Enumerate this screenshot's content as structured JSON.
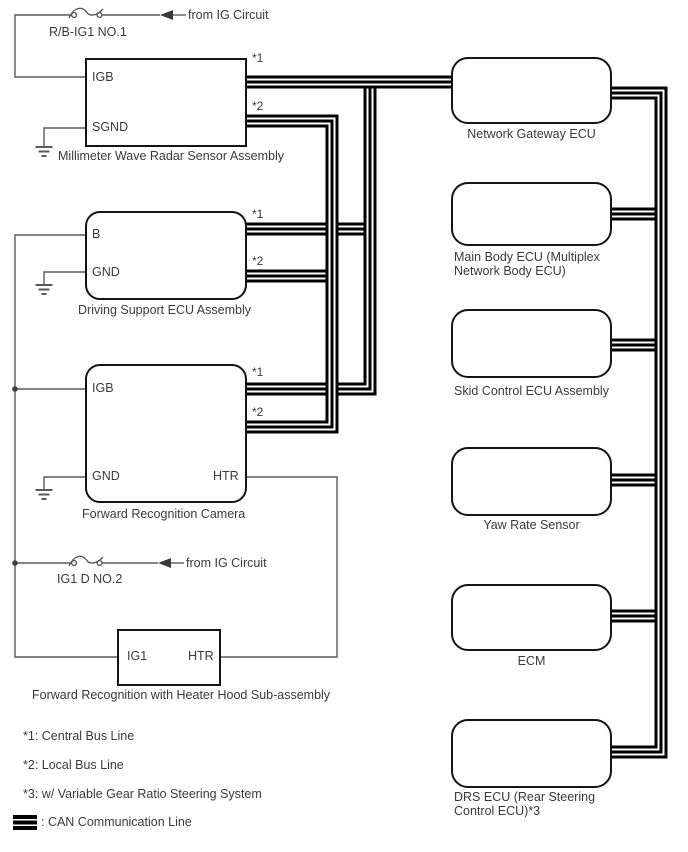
{
  "power": {
    "fuse1": {
      "label": "R/B-IG1 NO.1",
      "source": "from IG Circuit"
    },
    "fuse2": {
      "label": "IG1 D NO.2",
      "source": "from IG Circuit"
    }
  },
  "components": {
    "radar": {
      "label": "Millimeter Wave Radar Sensor Assembly",
      "pin_igb": "IGB",
      "pin_sgnd": "SGND",
      "bus1": "*1",
      "bus2": "*2"
    },
    "dse": {
      "label": "Driving Support ECU Assembly",
      "pin_b": "B",
      "pin_gnd": "GND",
      "bus1": "*1",
      "bus2": "*2"
    },
    "camera": {
      "label": "Forward Recognition Camera",
      "pin_igb": "IGB",
      "pin_gnd": "GND",
      "pin_htr": "HTR",
      "bus1": "*1",
      "bus2": "*2"
    },
    "hood": {
      "label": "Forward Recognition with Heater Hood Sub-assembly",
      "pin_ig1": "IG1",
      "pin_htr": "HTR"
    },
    "ngw": {
      "label": "Network Gateway ECU"
    },
    "main_body": {
      "line1": "Main Body ECU (Multiplex",
      "line2": "Network Body ECU)"
    },
    "skid": {
      "label": "Skid Control ECU Assembly"
    },
    "yaw": {
      "label": "Yaw Rate Sensor"
    },
    "ecm": {
      "label": "ECM"
    },
    "drs": {
      "line1": "DRS ECU (Rear Steering",
      "line2": "Control ECU)*3"
    }
  },
  "legend": {
    "note1": "*1: Central Bus Line",
    "note2": "*2: Local Bus Line",
    "note3": "*3: w/ Variable Gear Ratio Steering System",
    "can_label": ": CAN Communication Line"
  }
}
